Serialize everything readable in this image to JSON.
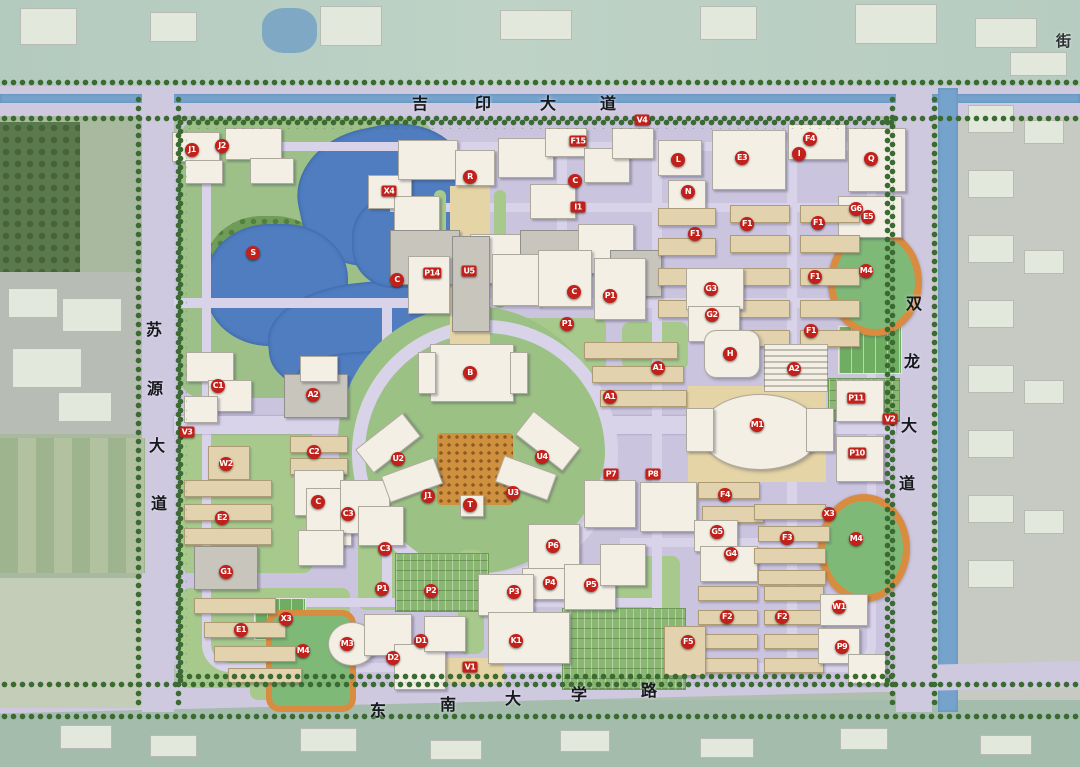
{
  "map_type": "campus-master-plan-aerial",
  "roads": {
    "top": {
      "label": "吉印大道"
    },
    "right": {
      "label": "双龙大道"
    },
    "left": {
      "label": "苏源大道"
    },
    "bottom": {
      "label": "东南大学路"
    }
  },
  "corner_label": "街",
  "palette": {
    "marker_red": "#c2201a",
    "road_lavender": "#d9d3ea",
    "campus_ground": "#cbc4de",
    "lake_blue": "#4f7dc0",
    "canal_blue": "#76a3cc",
    "park_green": "#9cc087",
    "tree_green": "#3c6a33",
    "track_orange": "#d98c3f",
    "building_white": "#f3efe4",
    "building_tan": "#e2d3ae"
  },
  "markers": [
    {
      "t": "J1",
      "x": 192,
      "y": 150
    },
    {
      "t": "J2",
      "x": 222,
      "y": 146
    },
    {
      "t": "X4",
      "x": 389,
      "y": 191,
      "s": 1
    },
    {
      "t": "S",
      "x": 253,
      "y": 253
    },
    {
      "t": "R",
      "x": 470,
      "y": 177
    },
    {
      "t": "V4",
      "x": 642,
      "y": 120,
      "s": 1
    },
    {
      "t": "F15",
      "x": 578,
      "y": 141,
      "s": 1
    },
    {
      "t": "C",
      "x": 575,
      "y": 181
    },
    {
      "t": "L",
      "x": 678,
      "y": 160
    },
    {
      "t": "E3",
      "x": 742,
      "y": 158
    },
    {
      "t": "N",
      "x": 688,
      "y": 192
    },
    {
      "t": "I1",
      "x": 578,
      "y": 207,
      "s": 1
    },
    {
      "t": "F4",
      "x": 810,
      "y": 139
    },
    {
      "t": "I",
      "x": 799,
      "y": 154
    },
    {
      "t": "Q",
      "x": 871,
      "y": 159
    },
    {
      "t": "G6",
      "x": 856,
      "y": 209
    },
    {
      "t": "E5",
      "x": 868,
      "y": 217
    },
    {
      "t": "F1",
      "x": 695,
      "y": 234
    },
    {
      "t": "F1",
      "x": 747,
      "y": 224
    },
    {
      "t": "F1",
      "x": 818,
      "y": 223
    },
    {
      "t": "F1",
      "x": 815,
      "y": 277
    },
    {
      "t": "F1",
      "x": 811,
      "y": 331
    },
    {
      "t": "M4",
      "x": 866,
      "y": 271
    },
    {
      "t": "C",
      "x": 397,
      "y": 280
    },
    {
      "t": "P14",
      "x": 432,
      "y": 273,
      "s": 1
    },
    {
      "t": "U5",
      "x": 469,
      "y": 271,
      "s": 1
    },
    {
      "t": "C",
      "x": 574,
      "y": 292
    },
    {
      "t": "P1",
      "x": 610,
      "y": 296
    },
    {
      "t": "G3",
      "x": 711,
      "y": 289
    },
    {
      "t": "G2",
      "x": 712,
      "y": 315
    },
    {
      "t": "P1",
      "x": 567,
      "y": 324
    },
    {
      "t": "H",
      "x": 730,
      "y": 354
    },
    {
      "t": "A1",
      "x": 658,
      "y": 368
    },
    {
      "t": "A1",
      "x": 610,
      "y": 397
    },
    {
      "t": "A2",
      "x": 794,
      "y": 369
    },
    {
      "t": "C1",
      "x": 218,
      "y": 386
    },
    {
      "t": "A2",
      "x": 313,
      "y": 395
    },
    {
      "t": "B",
      "x": 470,
      "y": 373
    },
    {
      "t": "M1",
      "x": 757,
      "y": 425
    },
    {
      "t": "V2",
      "x": 890,
      "y": 419,
      "s": 1
    },
    {
      "t": "P11",
      "x": 856,
      "y": 398,
      "s": 1
    },
    {
      "t": "P10",
      "x": 857,
      "y": 453,
      "s": 1
    },
    {
      "t": "V3",
      "x": 187,
      "y": 432,
      "s": 1
    },
    {
      "t": "W2",
      "x": 226,
      "y": 464
    },
    {
      "t": "C2",
      "x": 314,
      "y": 452
    },
    {
      "t": "U2",
      "x": 398,
      "y": 459
    },
    {
      "t": "U4",
      "x": 542,
      "y": 457
    },
    {
      "t": "J1",
      "x": 428,
      "y": 496
    },
    {
      "t": "U3",
      "x": 513,
      "y": 493
    },
    {
      "t": "T",
      "x": 470,
      "y": 505
    },
    {
      "t": "P7",
      "x": 611,
      "y": 474,
      "s": 1
    },
    {
      "t": "P8",
      "x": 653,
      "y": 474,
      "s": 1
    },
    {
      "t": "E2",
      "x": 222,
      "y": 518
    },
    {
      "t": "C",
      "x": 318,
      "y": 502
    },
    {
      "t": "C3",
      "x": 348,
      "y": 514
    },
    {
      "t": "C3",
      "x": 385,
      "y": 549
    },
    {
      "t": "G1",
      "x": 226,
      "y": 572
    },
    {
      "t": "P1",
      "x": 382,
      "y": 589
    },
    {
      "t": "P2",
      "x": 431,
      "y": 591
    },
    {
      "t": "P6",
      "x": 553,
      "y": 546
    },
    {
      "t": "P4",
      "x": 550,
      "y": 583
    },
    {
      "t": "P3",
      "x": 514,
      "y": 592
    },
    {
      "t": "P5",
      "x": 591,
      "y": 585
    },
    {
      "t": "F4",
      "x": 725,
      "y": 495
    },
    {
      "t": "G5",
      "x": 717,
      "y": 532
    },
    {
      "t": "G4",
      "x": 731,
      "y": 554
    },
    {
      "t": "F3",
      "x": 787,
      "y": 538
    },
    {
      "t": "X3",
      "x": 829,
      "y": 514
    },
    {
      "t": "M4",
      "x": 856,
      "y": 539
    },
    {
      "t": "E1",
      "x": 241,
      "y": 630
    },
    {
      "t": "X3",
      "x": 286,
      "y": 619
    },
    {
      "t": "M4",
      "x": 303,
      "y": 651
    },
    {
      "t": "M3",
      "x": 347,
      "y": 644
    },
    {
      "t": "D2",
      "x": 393,
      "y": 658
    },
    {
      "t": "D1",
      "x": 421,
      "y": 641
    },
    {
      "t": "K1",
      "x": 516,
      "y": 641
    },
    {
      "t": "V1",
      "x": 470,
      "y": 667,
      "s": 1
    },
    {
      "t": "F5",
      "x": 688,
      "y": 642
    },
    {
      "t": "F2",
      "x": 727,
      "y": 617
    },
    {
      "t": "F2",
      "x": 782,
      "y": 617
    },
    {
      "t": "W1",
      "x": 839,
      "y": 607
    },
    {
      "t": "P9",
      "x": 842,
      "y": 647
    }
  ]
}
